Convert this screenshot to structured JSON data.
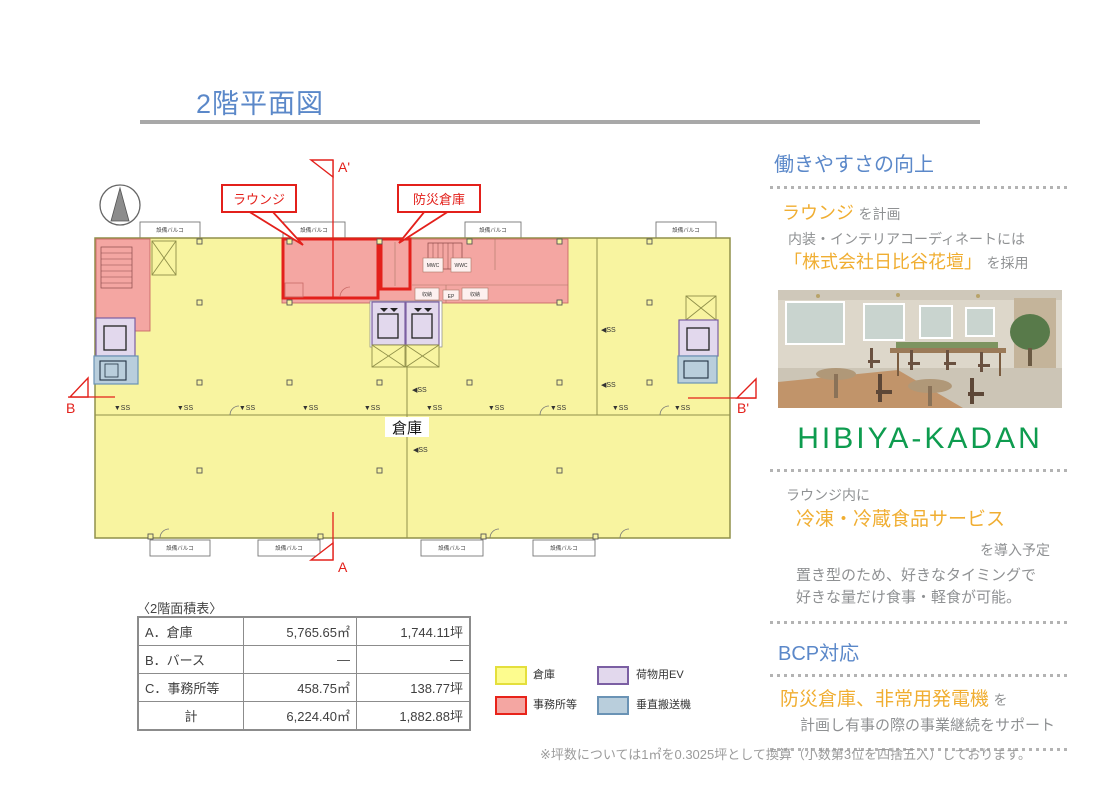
{
  "page": {
    "title": "2階平面図",
    "footnote": "※坪数については1㎡を0.3025坪として換算（小数第3位を四捨五入）しております。"
  },
  "colors": {
    "title_blue": "#5b88c9",
    "highlight_orange": "#f0ae32",
    "logo_green": "#0e9c4f",
    "warehouse_fill": "#f8f4a0",
    "office_fill": "#f4a6a2",
    "office_border": "#e3201b",
    "ev_fill": "#e2d8ed",
    "ev_border": "#7b5fa3",
    "conveyor_fill": "#b9cedc",
    "conveyor_border": "#6a93b5"
  },
  "plan": {
    "callouts": {
      "lounge": "ラウンジ",
      "disaster_storage": "防災倉庫"
    },
    "labels": {
      "warehouse": "倉庫",
      "balcony": "設備バルコ",
      "ss_down": "▼SS",
      "ss_left": "◀SS",
      "mwc": "MWC",
      "wwc": "WWC",
      "storage": "収納",
      "ep": "EP"
    },
    "section_markers": {
      "a": "A",
      "a_prime": "A'",
      "b": "B",
      "b_prime": "B'"
    }
  },
  "area_table": {
    "caption": "〈2階面積表〉",
    "rows": [
      {
        "label": "A．倉庫",
        "sqm": "5,765.65㎡",
        "tsubo": "1,744.11坪"
      },
      {
        "label": "B．バース",
        "sqm": "―",
        "tsubo": "―"
      },
      {
        "label": "C．事務所等",
        "sqm": "458.75㎡",
        "tsubo": "138.77坪"
      },
      {
        "label": "計",
        "sqm": "6,224.40㎡",
        "tsubo": "1,882.88坪"
      }
    ]
  },
  "legend": {
    "items": [
      {
        "label": "倉庫",
        "fill": "#fdfc8e",
        "border": "#e4df3c"
      },
      {
        "label": "事務所等",
        "fill": "#f4a6a2",
        "border": "#e8231a"
      },
      {
        "label": "荷物用EV",
        "fill": "#e2d8ed",
        "border": "#7b5fa3"
      },
      {
        "label": "垂直搬送機",
        "fill": "#b9cedc",
        "border": "#6a93b5"
      }
    ]
  },
  "sidebar": {
    "section1": {
      "heading": "働きやすさの向上",
      "line1_highlight": "ラウンジ",
      "line1_rest": "を計画",
      "line2": "内装・インテリアコーディネートには",
      "line3_highlight": "「株式会社日比谷花壇」",
      "line3_rest": "を採用",
      "logo": "HIBIYA-KADAN"
    },
    "section2": {
      "line1": "ラウンジ内に",
      "line2_highlight": "冷凍・冷蔵食品サービス",
      "line3": "を導入予定",
      "line4": "置き型のため、好きなタイミングで",
      "line5": "好きな量だけ食事・軽食が可能。"
    },
    "section3": {
      "heading": "BCP対応",
      "line1_highlight": "防災倉庫、非常用発電機",
      "line1_rest": "を",
      "line2": "計画し有事の際の事業継続をサポート"
    }
  }
}
